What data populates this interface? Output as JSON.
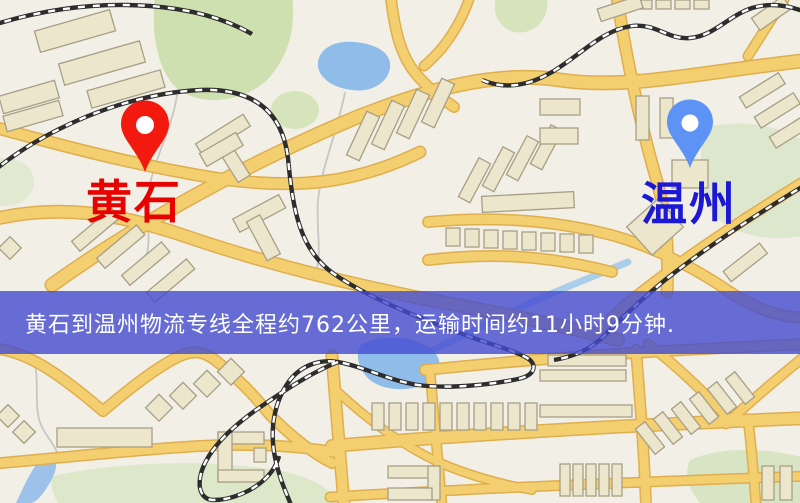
{
  "map": {
    "origin": {
      "label": "黄石"
    },
    "destination": {
      "label": "温州"
    },
    "banner": {
      "text": "黄石到温州物流专线全程约762公里，运输时间约11小时9分钟.",
      "distance_km": 762,
      "duration_hours": 11,
      "duration_minutes": 9
    },
    "colors": {
      "origin_pin": "#f2190f",
      "destination_pin": "#5d93f4",
      "origin_label": "#e60200",
      "destination_label": "#1c18d4",
      "banner_bg": "rgba(67,75,209,0.80)",
      "banner_text": "#ffffff",
      "road": "#f4cf70",
      "road_casing": "#dfae4e",
      "water": "#8fbce8",
      "park": "#cfe0b0",
      "building": "#ece6cc",
      "background": "#f2efe7"
    }
  }
}
